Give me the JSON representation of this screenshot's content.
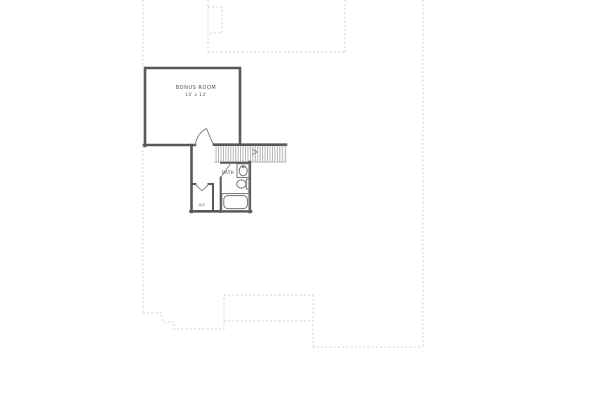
{
  "plan": {
    "type": "floor-plan-second-level",
    "labels": {
      "bonus_room": "BONUS ROOM",
      "bonus_room_dims": "14' x 13'",
      "bath": "BATH",
      "closet": "A/C"
    },
    "features": [
      "bonus-room",
      "staircase",
      "bathroom",
      "bathtub",
      "toilet",
      "sink-vanity",
      "closet",
      "roof-outline-dashed"
    ],
    "colors": {
      "wall": "#58585a",
      "fixture": "#757575",
      "tread": "#b4b4b4",
      "dashed": "#cdcdcd",
      "text": "#4f4f4f",
      "door": "#8a8a8a",
      "background": "#ffffff"
    }
  }
}
